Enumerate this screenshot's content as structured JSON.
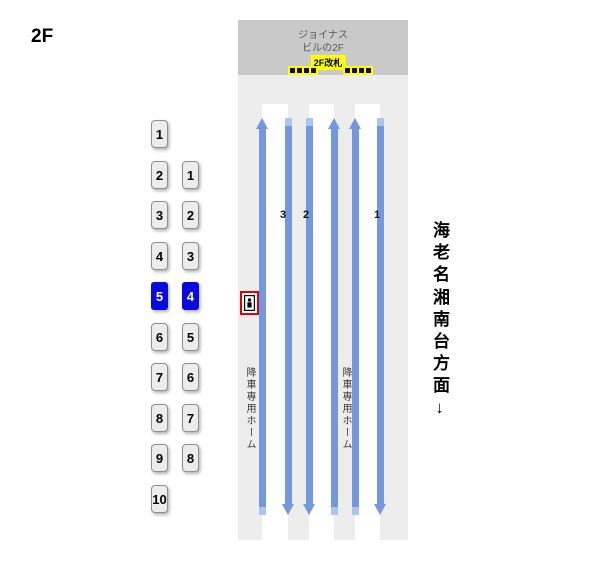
{
  "floor_label": "2F",
  "building": {
    "line1": "ジョイナス",
    "line2": "ビルの2F"
  },
  "gate": {
    "label": "2F改札",
    "groups": [
      4,
      4
    ]
  },
  "tracks": {
    "numbers": [
      "3",
      "2",
      "1"
    ],
    "line_directions": [
      "up",
      "down",
      "down",
      "up",
      "up",
      "down"
    ],
    "platform_label": "降車専用ホーム",
    "platform_label_count": 2
  },
  "direction": {
    "group1": "海老名",
    "group2": "湘南台方面",
    "arrow": "↓"
  },
  "car_columns": [
    {
      "items": [
        "1",
        "2",
        "3",
        "4",
        "5",
        "6",
        "7",
        "8",
        "9",
        "10"
      ],
      "highlighted": "5"
    },
    {
      "items": [
        "1",
        "2",
        "3",
        "4",
        "5",
        "6",
        "7",
        "8"
      ],
      "highlighted": "4"
    }
  ],
  "elevator": {
    "icon": "elevator-icon"
  },
  "colors": {
    "accent_blue": "#7497dd",
    "accent_blue_light": "#adc4ec",
    "highlight_blue": "#0a0ae0",
    "gate_yellow": "#ffff00",
    "elevator_red": "#e00000",
    "building_gray": "#c9c9c9",
    "area_gray": "#ededed"
  }
}
